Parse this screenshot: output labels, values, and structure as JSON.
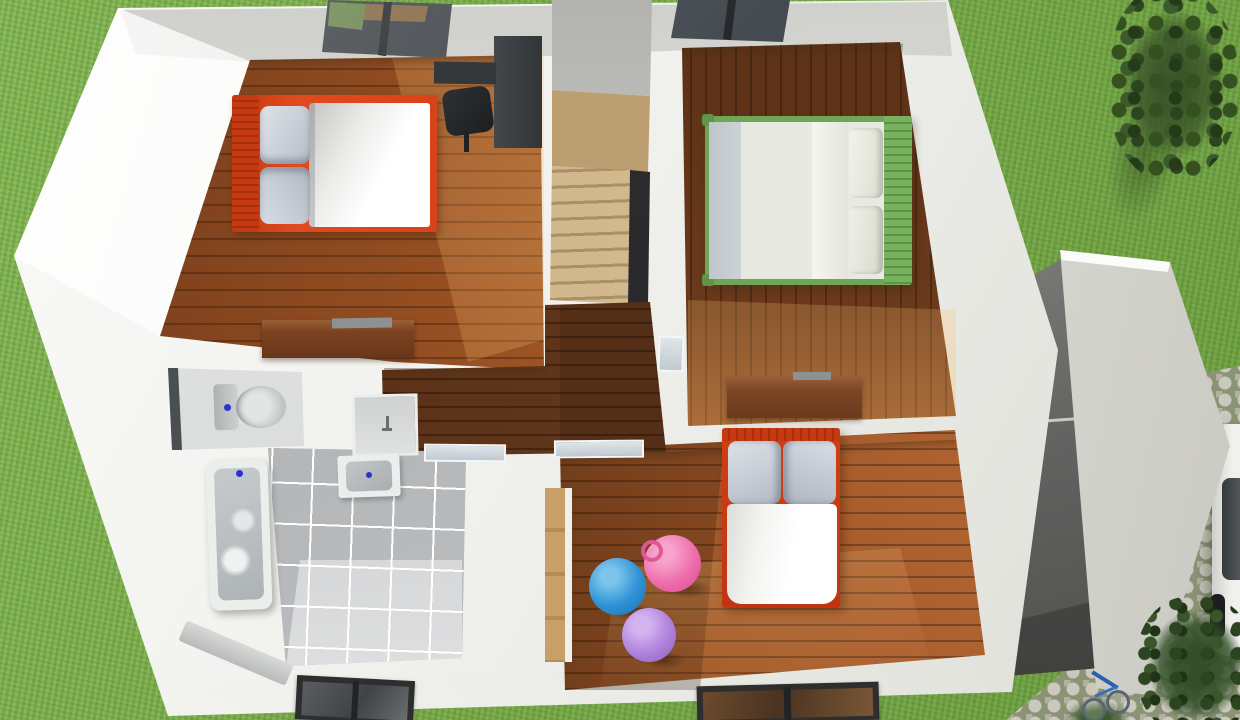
{
  "scene": {
    "title": "3D dollhouse floor plan — upper floor, top-down render",
    "description": "Photorealistic top-down 3D render of a house upper floor with white walls: top-left bedroom with red-frame double bed, desk and skylight; top-right bedroom with green-frame double bed and skylight; central winding staircase; hallway; bathroom with toilet, washbasin and bathtub on grey tile; bottom-right kids bedroom with red-frame bed, wood dresser, wardrobe and pink, blue and purple bouncy balls; lawn on both sides, tree and shrubs, flat-roof garage annex with terrace, cobblestone driveway with a white parked car and a blue bicycle.",
    "environment": {
      "lawn_color": "#7cad4e",
      "tree": "dark green shrub, top right lawn",
      "shrubs": "dark green bushes, bottom right",
      "driveway": "grey cobblestone path, right edge",
      "car": {
        "color": "#eeeeea",
        "position": "parked on driveway, partially cropped at right edge",
        "details": [
          "dark window band",
          "two dark wheels"
        ]
      },
      "bicycle": {
        "color": "#2a5fae",
        "position": "bottom edge near garage"
      }
    },
    "house": {
      "walls_color": "#f1f1ee",
      "annex": {
        "name": "garage",
        "roof_color": "#e7e7e3",
        "terrace": "dark grey open terrace with railing between house and garage"
      },
      "stairs": {
        "style": "winder staircase",
        "tread_color": "#c4a87a",
        "stairwell_void": "#2e2e30"
      },
      "skylights": 2,
      "rooms": [
        {
          "name": "bedroom-top-left",
          "floor": "orange-brown wood planks, horizontal",
          "furniture": [
            "double bed with red frame, red slatted headboard, two grey pillows, white duvet",
            "dark charcoal desk with black office chair",
            "walnut dresser on south wall",
            "ceiling skylight"
          ]
        },
        {
          "name": "bedroom-top-right",
          "floor": "dark walnut wood planks, vertical, sunlit at south",
          "furniture": [
            "double bed with green slatted frame, cream duvet, two cream pillows, grey sheet strip",
            "walnut dresser on south wall",
            "ceiling skylight"
          ]
        },
        {
          "name": "bedroom-bottom-right",
          "floor": "orange-brown wood planks, shadowed at west",
          "furniture": [
            "bed with red frame and headboard, two grey pillows, white duvet",
            "tan wardrobe on west wall",
            "pink bouncy ball with handle",
            "blue bouncy ball",
            "purple bouncy ball",
            "window in south wall"
          ]
        },
        {
          "name": "bathroom",
          "floor": "grey square tiles",
          "furniture": [
            "toilet with cistern and blue flush button in niche",
            "small sink niche with faucet",
            "white washbasin with blue drain dot",
            "white bathtub with grey interior and blue faucet dot",
            "window in south wall"
          ]
        },
        {
          "name": "hallway",
          "floor": "dark walnut wood planks",
          "furniture": [
            "glass interior doors to bathroom and bedrooms"
          ]
        }
      ]
    },
    "palette": {
      "bed_red": "#d23f16",
      "bed_green": "#6fa556",
      "ball_pink": "#ef6fae",
      "ball_blue": "#2f93d6",
      "ball_purple": "#b083de",
      "wood_bright": "#a85c28",
      "wood_dark": "#5d3418",
      "tile_grey": "#b4b6b8",
      "accent_blue_dots": "#2a35c8"
    }
  }
}
